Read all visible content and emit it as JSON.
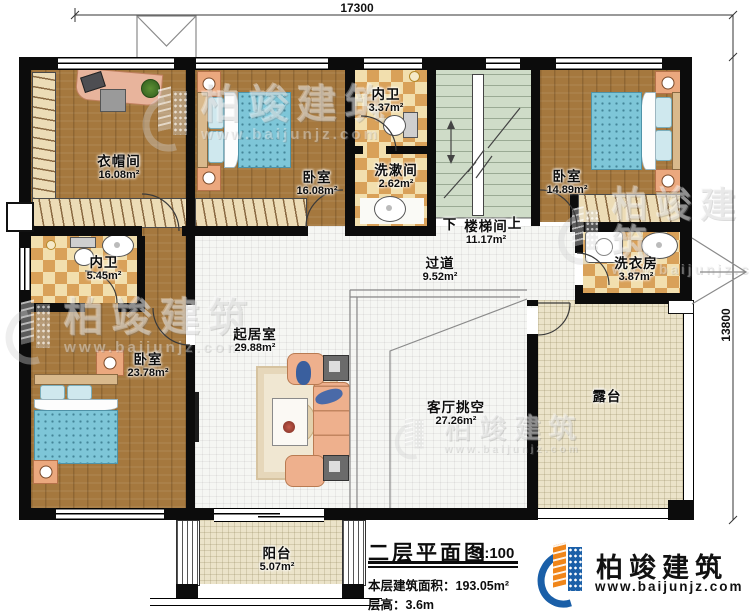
{
  "dimensions": {
    "top": "17300",
    "right": "13800"
  },
  "rooms": {
    "cloakroom": {
      "name": "衣帽间",
      "area": "16.08m²"
    },
    "bedroom1": {
      "name": "卧室",
      "area": "16.08m²"
    },
    "bath_top": {
      "name": "内卫",
      "area": "3.37m²"
    },
    "washroom": {
      "name": "洗漱间",
      "area": "2.62m²"
    },
    "stairwell": {
      "name": "楼梯间",
      "area": "11.17m²",
      "down_label": "下",
      "up_label": "上"
    },
    "bedroom2": {
      "name": "卧室",
      "area": "14.89m²"
    },
    "laundry": {
      "name": "洗衣房",
      "area": "3.87m²"
    },
    "bath_left": {
      "name": "内卫",
      "area": "5.45m²"
    },
    "bedroom3": {
      "name": "卧室",
      "area": "23.78m²"
    },
    "living": {
      "name": "起居室",
      "area": "29.88m²"
    },
    "hallway": {
      "name": "过道",
      "area": "9.52m²"
    },
    "void": {
      "name": "客厅挑空",
      "area": "27.26m²"
    },
    "terrace": {
      "name": "露台"
    },
    "balcony": {
      "name": "阳台",
      "area": "5.07m²"
    }
  },
  "title_block": {
    "title": "二层平面图",
    "scale": "1:100",
    "area_label": "本层建筑面积：",
    "area_value": "193.05m²",
    "height_label": "层高：",
    "height_value": "3.6m"
  },
  "brand": {
    "name": "柏竣建筑",
    "website": "www.baijunjz.com"
  },
  "watermark": {
    "name": "柏竣建筑",
    "website": "www.baijunjz.com"
  },
  "colors": {
    "wall": "#0c0c0c",
    "wood_floor": "#a5783e",
    "tile_light": "#f2dfae",
    "tile_dark": "#d9a159",
    "stair_green": "#cfdcc8",
    "floor_white": "#f5f6f3",
    "terrace_beige": "#ebe3c9",
    "bed_blue": "#7ec6d8",
    "furniture_salmon": "#eba87e",
    "brand_blue": "#1a5fa8",
    "brand_orange": "#f08519"
  }
}
